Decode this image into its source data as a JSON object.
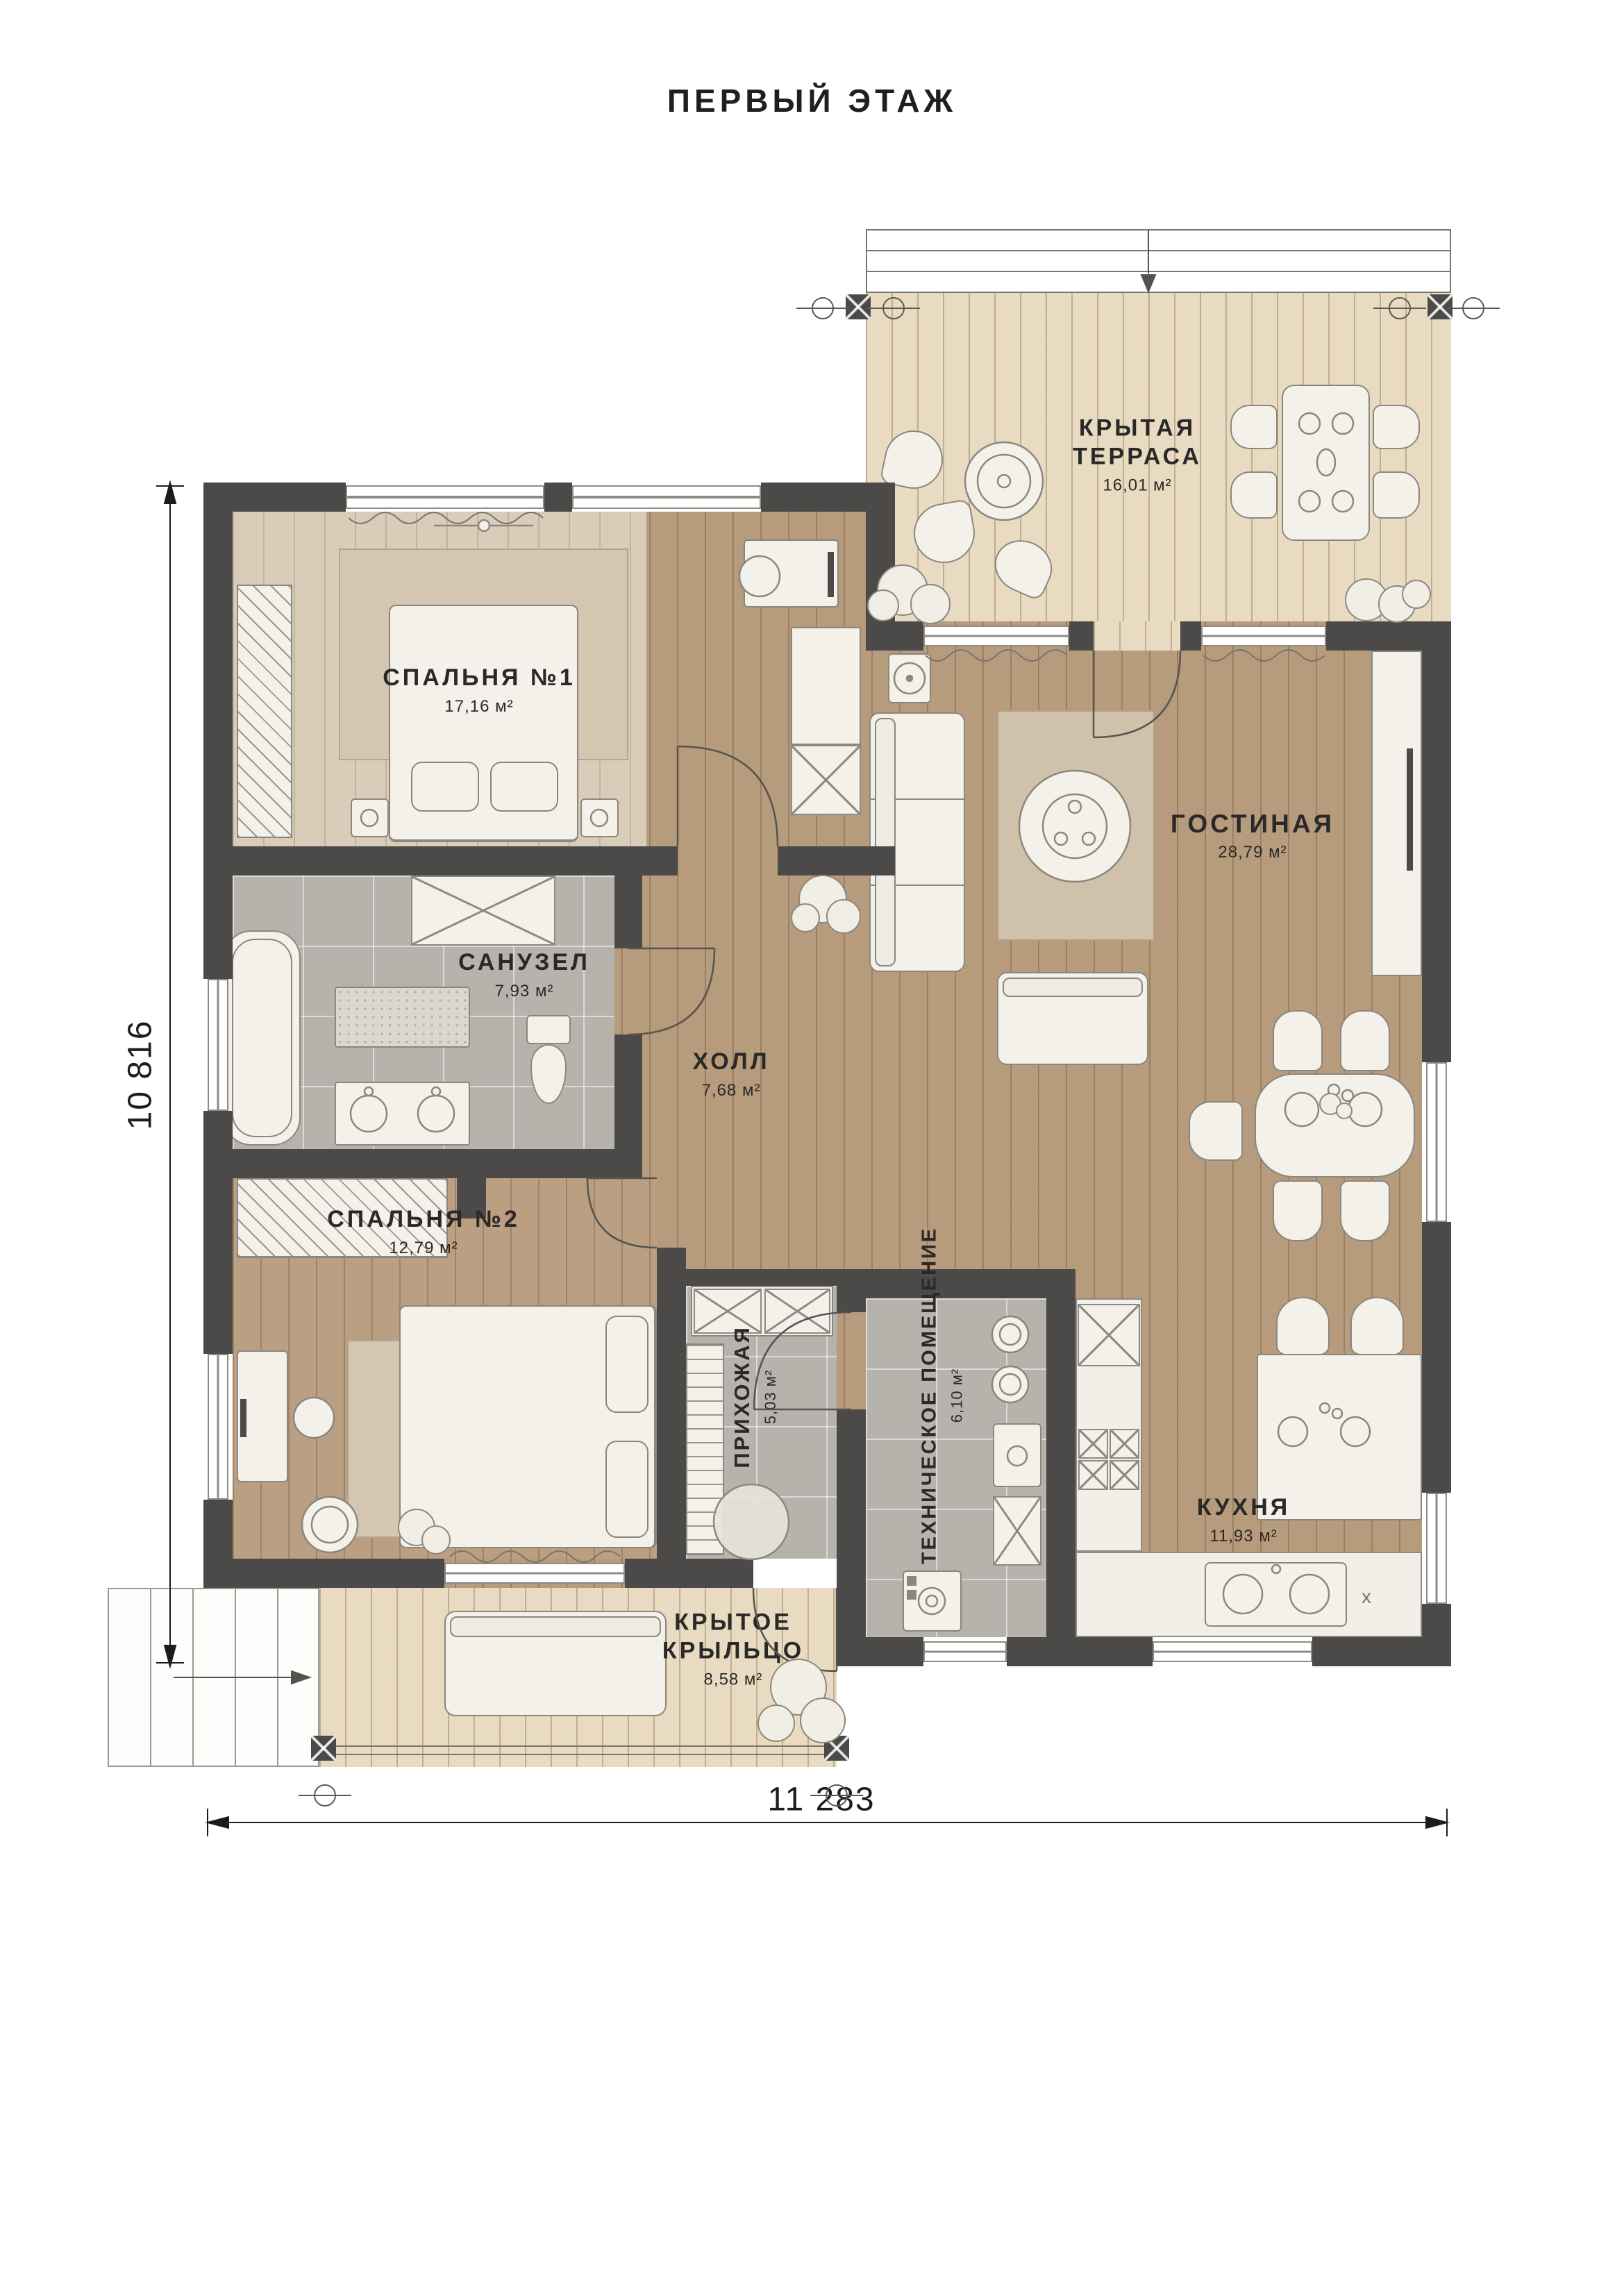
{
  "title": "ПЕРВЫЙ ЭТАЖ",
  "rooms": {
    "terrace": {
      "name_line1": "КРЫТАЯ",
      "name_line2": "ТЕРРАСА",
      "area": "16,01 м²"
    },
    "bedroom1": {
      "name": "СПАЛЬНЯ №1",
      "area": "17,16 м²"
    },
    "living_room": {
      "name": "ГОСТИНАЯ",
      "area": "28,79 м²"
    },
    "bathroom": {
      "name": "САНУЗЕЛ",
      "area": "7,93 м²"
    },
    "hall": {
      "name": "ХОЛЛ",
      "area": "7,68 м²"
    },
    "bedroom2": {
      "name": "СПАЛЬНЯ №2",
      "area": "12,79 м²"
    },
    "entry_hall": {
      "name": "ПРИХОЖАЯ",
      "area": "5,03 м²"
    },
    "technical_room": {
      "name": "ТЕХНИЧЕСКОЕ ПОМЕЩЕНИЕ",
      "area": "6,10 м²"
    },
    "kitchen": {
      "name": "КУХНЯ",
      "area": "11,93 м²"
    },
    "porch": {
      "name_line1": "КРЫТОЕ",
      "name_line2": "КРЫЛЬЦО",
      "area": "8,58 м²"
    }
  },
  "dimensions": {
    "overall_width_mm": "11 283",
    "overall_height_mm": "10 816"
  },
  "marks": {
    "kitchen_cooktop": "x"
  },
  "colors": {
    "wall": "#4c4a48",
    "wood_floor": "#b69b7d",
    "pale_floor": "#d9ccb8",
    "deck_floor": "#e8dbc2",
    "tile_floor": "#b6b3ad",
    "furniture": "#f4f1ea",
    "label_text": "#2a2927"
  }
}
